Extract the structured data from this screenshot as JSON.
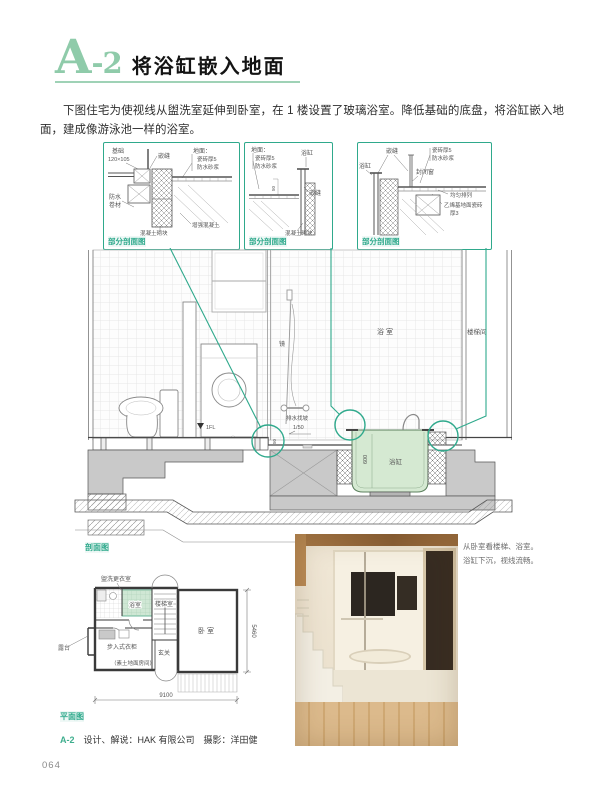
{
  "header": {
    "logo_letter": "A",
    "logo_suffix": "-2",
    "title": "将浴缸嵌入地面"
  },
  "intro": {
    "text": "下图住宅为使视线从盥洗室延伸到卧室，在 1 楼设置了玻璃浴室。降低基础的底盘，将浴缸嵌入地面，建成像游泳池一样的浴室。"
  },
  "colors": {
    "accent_green": "#8fcbaa",
    "teal": "#2fa98c",
    "tub_fill": "#d5e9d2",
    "plan_bath_fill": "#cfe7d4",
    "concrete_gray": "#c9c9c9"
  },
  "details": {
    "tag": "部分剖面图",
    "d1": {
      "foundation": "基础",
      "size": "120×105",
      "caulk": "嵌缝",
      "floor": "地面：",
      "tile": "瓷砖厚5",
      "mortar": "防水砂浆",
      "wp1": "防水",
      "wp2": "卷材",
      "block": "混凝土砌块",
      "reinforced": "增强混凝土"
    },
    "d2": {
      "floor": "地面：",
      "tile": "瓷砖厚5",
      "mortar": "防水砂浆",
      "tub": "浴缸",
      "dim50": "50",
      "caulk": "嵌缝",
      "block": "混凝土砌块"
    },
    "d3": {
      "caulk": "嵌缝",
      "tile": "瓷砖厚5",
      "mortar": "防水砂浆",
      "tub": "浴缸",
      "window": "封闭窗",
      "even": "均匀排列",
      "vinyl": "乙烯基地面瓷砖",
      "thick": "厚3"
    }
  },
  "section": {
    "tag": "剖面图",
    "bath": "浴室",
    "stairhall": "楼梯间",
    "mirror": "镜",
    "fl": "1FL",
    "slope1": "排水找坡",
    "slope2": "1/50",
    "dim50": "50",
    "tub": "浴缸",
    "dim600": "600"
  },
  "plan": {
    "tag": "平面图",
    "laundry": "盥洗更衣室",
    "bath": "浴室",
    "stair": "楼梯室",
    "bedroom": "卧室",
    "closet": "步入式衣柜",
    "entry": "玄关",
    "entry_note": "（素土地面房间）",
    "terrace": "露台",
    "dim_w": "9100",
    "dim_h": "5460"
  },
  "photo": {
    "caption1": "从卧室看楼梯、浴室。",
    "caption2": "浴缸下沉，视线流畅。"
  },
  "credit": {
    "label": "A-2",
    "text": "设计、解说：HAK 有限公司　摄影：洋田健"
  },
  "page": {
    "number": "064"
  }
}
